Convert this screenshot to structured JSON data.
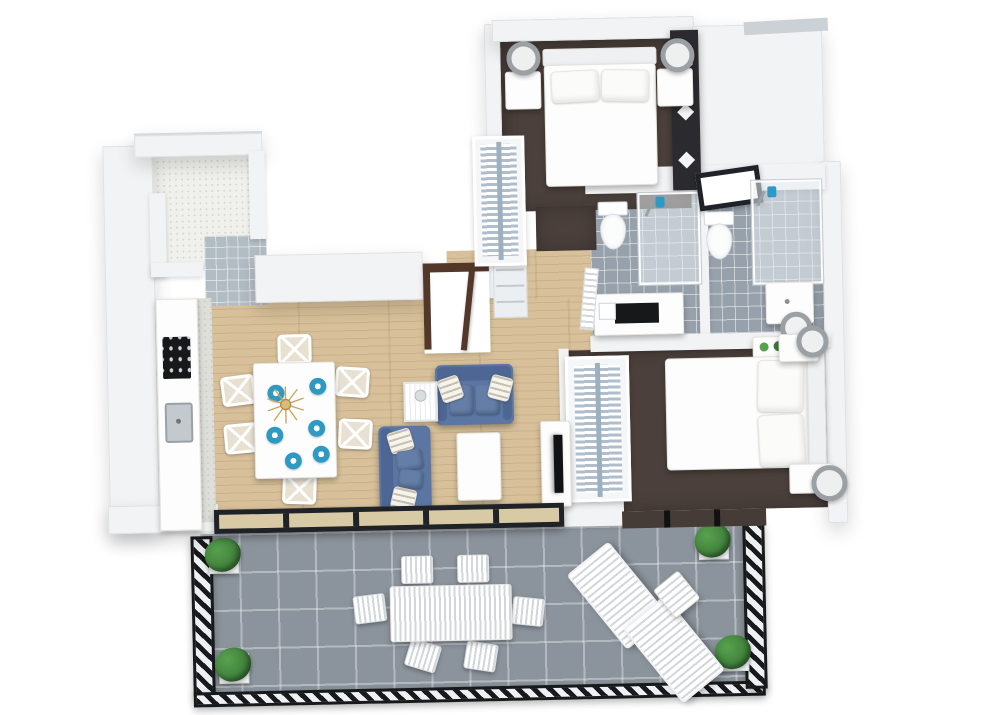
{
  "scene": {
    "description": "3D rendered top-down floor plan of an apartment with white walls on a white background",
    "background": "#ffffff"
  },
  "palette": {
    "wall": "#f2f3f4",
    "wall_edge": "#dfe2e5",
    "wall_dark": "#453c37",
    "carpet": "#4b403c",
    "wood": "#d8c19a",
    "bath_tile": "#97a1ab",
    "terrace_tile": "#8b939c",
    "corridor_tile": "#b2bcc3",
    "marble": "#f0f0ec",
    "sofa": "#5b76a2",
    "sofa_dark": "#4d6694",
    "cushion": "#647ea8",
    "accent": "#2e9ac4",
    "door_brown": "#53382a",
    "frame_black": "#1f2327",
    "divider": "#2b2a2e",
    "rod": "#9db0bf",
    "lamp": "#9aa0a4",
    "cream": "#e8e1d2",
    "counter_black": "#17181a",
    "green": "#3c7a38",
    "green_light": "#58a24f"
  },
  "plan": {
    "view": "isometric-3d-floorplan",
    "rooms": [
      {
        "name": "bedroom-1",
        "floor": "dark-brown-carpet",
        "furniture": [
          "double-bed-white",
          "pillow x2",
          "nightstand x2",
          "table-lamp x2",
          "open-wardrobe-with-hanging-clothes",
          "dark-slatted-room-divider"
        ]
      },
      {
        "name": "bathroom-1",
        "floor": "grey-tile",
        "furniture": [
          "toilet",
          "walk-in-glass-shower",
          "vanity-with-black-counter",
          "door"
        ]
      },
      {
        "name": "bathroom-2",
        "floor": "grey-tile",
        "furniture": [
          "toilet",
          "walk-in-glass-shower",
          "sink",
          "round-laundry-basket",
          "plant-stand",
          "black-framed-window"
        ]
      },
      {
        "name": "bedroom-2",
        "floor": "dark-brown-carpet",
        "furniture": [
          "double-bed-white",
          "pillow x2",
          "nightstand x2",
          "table-lamp x2",
          "open-wardrobe-with-hanging-clothes"
        ]
      },
      {
        "name": "kitchen",
        "floor": "light-wood",
        "furniture": [
          "counter-run",
          "black-cooktop",
          "kitchen-sink",
          "marble-backsplash"
        ]
      },
      {
        "name": "dining-area",
        "floor": "light-wood",
        "furniture": [
          "white-dining-table",
          "chair x6",
          "blue-place-setting x6",
          "gold-centerpiece"
        ]
      },
      {
        "name": "living-area",
        "floor": "light-wood",
        "furniture": [
          "blue-sofa",
          "blue-chaise-sofa",
          "white-coffee-table",
          "wire-side-table",
          "tv-console",
          "flat-tv"
        ]
      },
      {
        "name": "entry-hall",
        "floor": "light-wood",
        "furniture": [
          "open-entry-door-brown",
          "hall-shelf"
        ]
      },
      {
        "name": "utility-room",
        "floor": "white-marble",
        "furniture": [
          "l-shaped-counter",
          "tiled-corridor"
        ]
      },
      {
        "name": "terrace",
        "floor": "grey-tile",
        "furniture": [
          "outdoor-dining-table",
          "outdoor-chair x6",
          "sun-lounger x2",
          "lounge-side-table",
          "corner-planter x4",
          "black-lattice-railing",
          "black-framed-window-wall"
        ]
      }
    ]
  }
}
